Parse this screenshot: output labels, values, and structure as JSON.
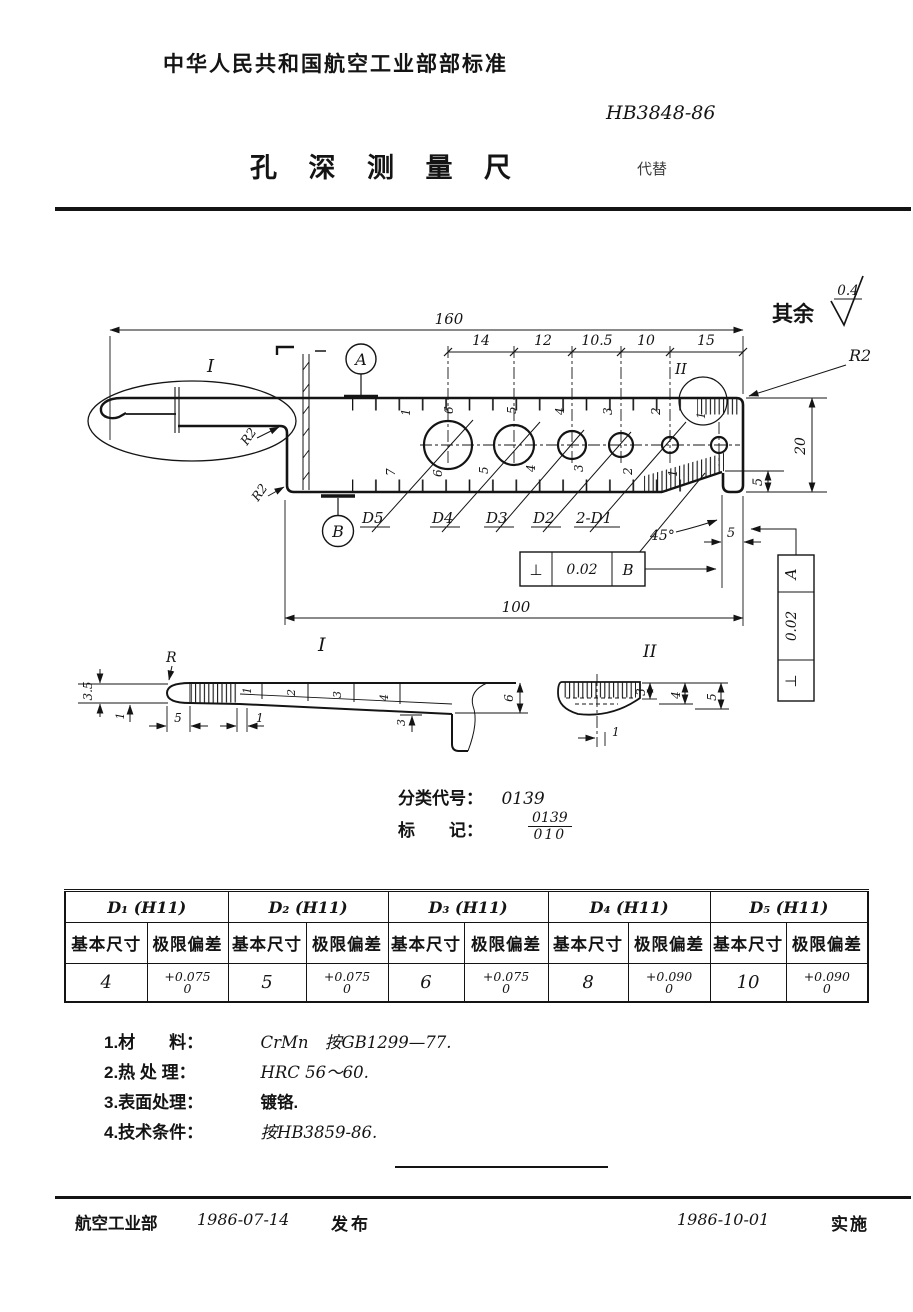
{
  "header": {
    "org": "中华人民共和国航空工业部部标准",
    "code": "HB3848-86",
    "title": "孔 深 测 量 尺",
    "replaces": "代替"
  },
  "drawing": {
    "dim_160": "160",
    "spacing_dims": [
      "14",
      "12",
      "10.5",
      "10",
      "15"
    ],
    "surface_note": "其余",
    "surface_value": "0.4",
    "r2_top": "R2",
    "r2_blade": "R2",
    "r2_corner": "R2",
    "dim_20": "20",
    "dim_5_step": "5",
    "dim_5_foot": "5",
    "dim_100": "100",
    "angle_45": "45°",
    "hole_labels": [
      "D5",
      "D4",
      "D3",
      "D2",
      "2-D1"
    ],
    "datum_a": "A",
    "datum_b": "B",
    "view1_label": "I",
    "view2_label": "II",
    "fcf_b": {
      "sym": "⊥",
      "tol": "0.02",
      "ref": "B"
    },
    "fcf_a": {
      "sym": "⊥",
      "tol": "0.02",
      "ref": "A"
    },
    "scale_top": [
      "1",
      "6",
      "5",
      "4",
      "3",
      "2"
    ],
    "scale_circle": "1",
    "scale_bottom": [
      "7",
      "6",
      "5",
      "4",
      "3",
      "2",
      "1"
    ],
    "detail1": {
      "label": "I",
      "radius": "R",
      "t35": "3.5",
      "t1": "1",
      "k5": "5",
      "k1": "1",
      "scale": [
        "1",
        "2",
        "3",
        "4"
      ],
      "d3": "3",
      "d6": "6"
    },
    "detail2": {
      "label": "II",
      "d1": "1",
      "d3": "3",
      "d4": "4",
      "d5": "5"
    }
  },
  "classification": {
    "code_label": "分类代号：",
    "code": "0139",
    "mark_label": "标　　记：",
    "mark_num": "0139",
    "mark_den": "010"
  },
  "table": {
    "groups": [
      {
        "name": "D₁ (H11)",
        "basic_h": "基本尺寸",
        "dev_h": "极限偏差",
        "basic": "4",
        "dev_top": "+0.075",
        "dev_bot": "0"
      },
      {
        "name": "D₂ (H11)",
        "basic_h": "基本尺寸",
        "dev_h": "极限偏差",
        "basic": "5",
        "dev_top": "+0.075",
        "dev_bot": "0"
      },
      {
        "name": "D₃ (H11)",
        "basic_h": "基本尺寸",
        "dev_h": "极限偏差",
        "basic": "6",
        "dev_top": "+0.075",
        "dev_bot": "0"
      },
      {
        "name": "D₄ (H11)",
        "basic_h": "基本尺寸",
        "dev_h": "极限偏差",
        "basic": "8",
        "dev_top": "+0.090",
        "dev_bot": "0"
      },
      {
        "name": "D₅ (H11)",
        "basic_h": "基本尺寸",
        "dev_h": "极限偏差",
        "basic": "10",
        "dev_top": "+0.090",
        "dev_bot": "0"
      }
    ]
  },
  "notes": [
    {
      "label": "1.材　　料：",
      "value": "CrMn　按GB1299—77."
    },
    {
      "label": "2.热 处 理：",
      "value": "HRC 56～60."
    },
    {
      "label": "3.表面处理：",
      "value": "镀铬."
    },
    {
      "label": "4.技术条件：",
      "value": "按HB3859-86."
    }
  ],
  "footer": {
    "issuer": "航空工业部",
    "issue_date": "1986-07-14",
    "publish_label": "发布",
    "effective_date": "1986-10-01",
    "implement_label": "实施"
  }
}
